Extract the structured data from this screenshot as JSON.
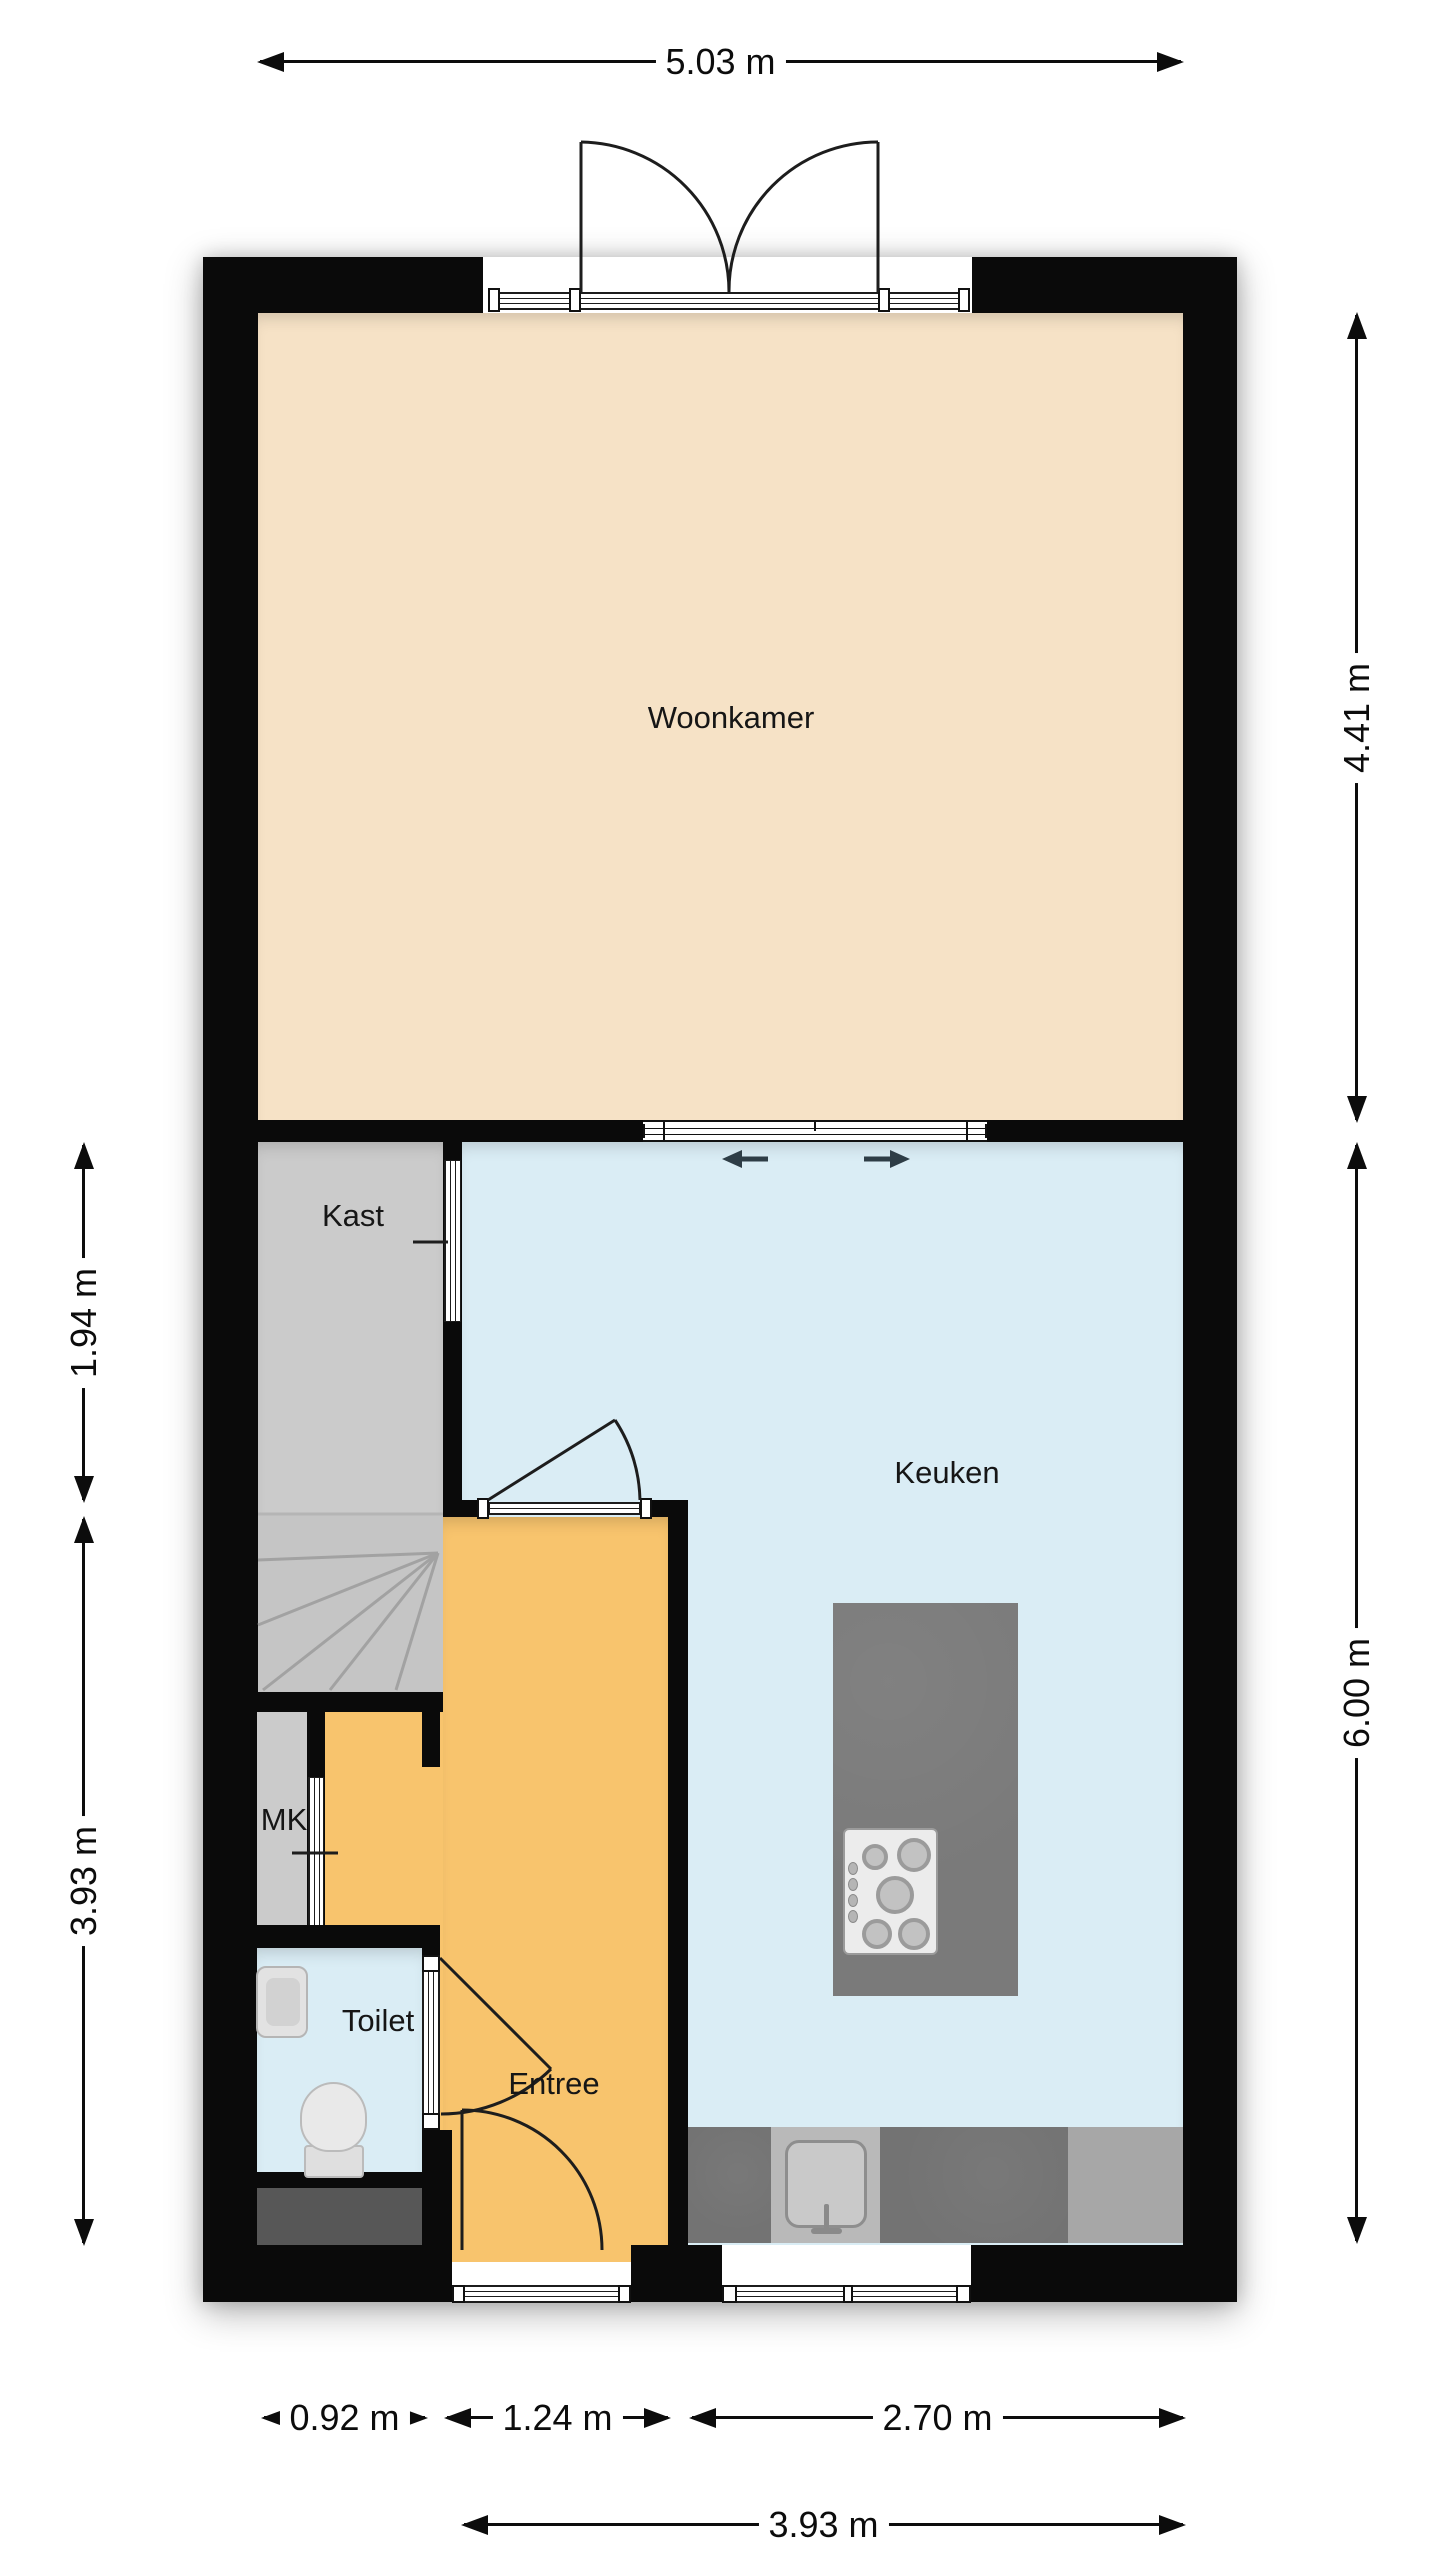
{
  "plan": {
    "type": "floorplan",
    "rooms": [
      {
        "id": "woonkamer",
        "label": "Woonkamer"
      },
      {
        "id": "kast",
        "label": "Kast"
      },
      {
        "id": "keuken",
        "label": "Keuken"
      },
      {
        "id": "mk",
        "label": "MK"
      },
      {
        "id": "toilet",
        "label": "Toilet"
      },
      {
        "id": "entree",
        "label": "Entree"
      }
    ],
    "dimensions": {
      "top_width": "5.03 m",
      "right_upper": "4.41 m",
      "right_lower": "6.00 m",
      "left_upper": "1.94 m",
      "left_lower": "3.93 m",
      "bottom_segments": [
        "0.92 m",
        "1.24 m",
        "2.70 m"
      ],
      "bottom_total": "3.93 m"
    },
    "icons": {
      "stove": "gas-hob-5-burners",
      "sink": "kitchen-sink-with-faucet",
      "island": "kitchen-island",
      "counter": "kitchen-counter",
      "wc": "toilet-bowl-with-tank",
      "basin": "washbasin",
      "stairs": "winder-staircase",
      "double_door": "french-doors-swing",
      "sliding_door": "sliding-door-arrows"
    },
    "colors": {
      "wall": "#0a0a0a",
      "woonkamer_floor": "#f6e2c6",
      "keuken_floor": "#daedf5",
      "toilet_floor": "#daedf5",
      "entree_floor": "#f8c46d",
      "kast_floor": "#cbcbcb",
      "stairs_floor": "#c5c5c5",
      "island": "#7a7a7a",
      "counter_dark": "#737373",
      "counter_light": "#a7a7a7",
      "niche_dark": "#575757",
      "background": "#ffffff",
      "dimension_text": "#0c0c0c"
    }
  }
}
